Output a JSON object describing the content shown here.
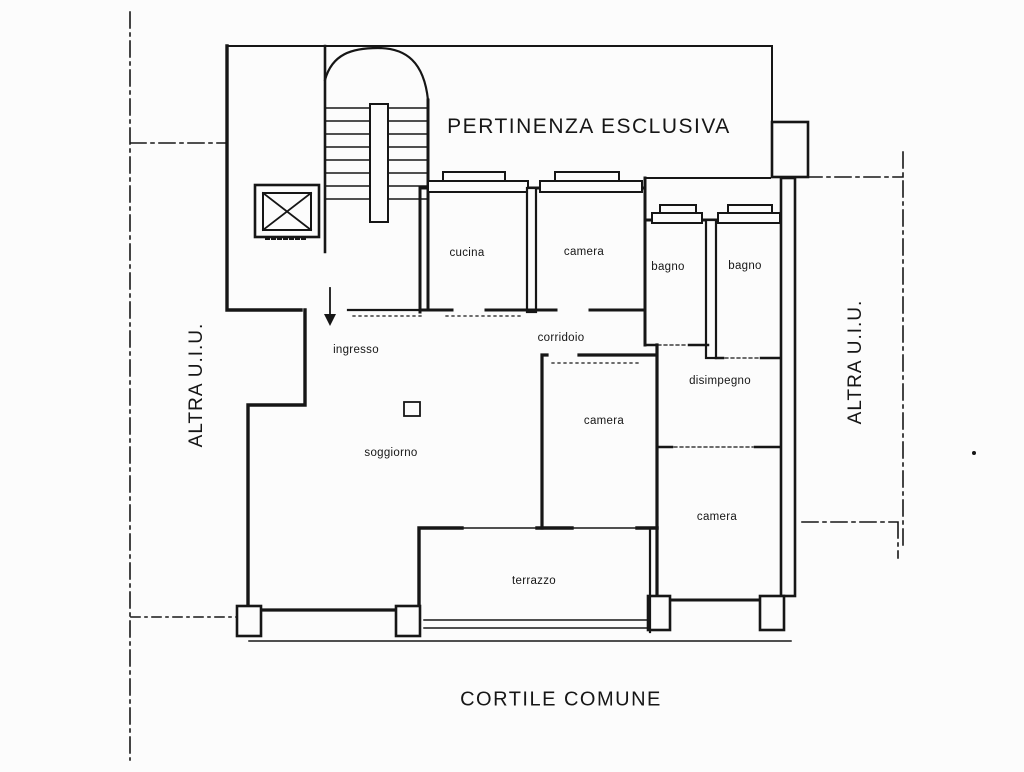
{
  "colors": {
    "ink": "#161616",
    "background": "#fcfcfc"
  },
  "area_labels": {
    "top": "PERTINENZA ESCLUSIVA",
    "bottom": "CORTILE COMUNE",
    "left_side": "ALTRA U.I.U.",
    "right_side": "ALTRA U.I.U."
  },
  "rooms": [
    {
      "label": "cucina"
    },
    {
      "label": "camera"
    },
    {
      "label": "bagno"
    },
    {
      "label": "bagno"
    },
    {
      "label": "ingresso"
    },
    {
      "label": "corridoio"
    },
    {
      "label": "disimpegno"
    },
    {
      "label": "camera"
    },
    {
      "label": "soggiorno"
    },
    {
      "label": "camera"
    },
    {
      "label": "terrazzo"
    }
  ],
  "icons": {
    "elevator": "elevator-shaft-icon",
    "staircase": "staircase-icon",
    "entrance": "entrance-arrow-icon"
  }
}
